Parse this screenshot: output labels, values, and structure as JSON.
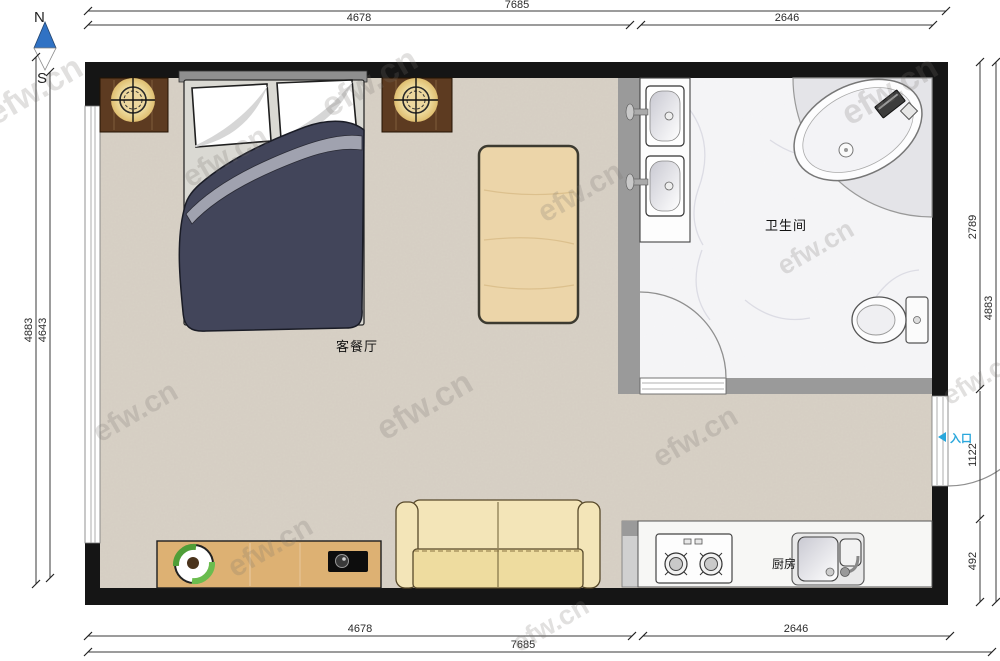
{
  "compass": {
    "north": "N",
    "south": "S"
  },
  "rooms": {
    "living_dining": "客餐厅",
    "bathroom": "卫生间",
    "kitchen": "厨房",
    "entrance": "入口"
  },
  "dimensions_mm": {
    "top_total": "7685",
    "top_left_segment": "4678",
    "top_right_segment": "2646",
    "bottom_left_segment": "4678",
    "bottom_right_segment": "2646",
    "bottom_total": "7685",
    "left_outer": "4883",
    "left_inner": "4643",
    "right_bathroom": "2789",
    "right_full": "4883",
    "right_entrance": "1122",
    "right_kitchen": "492"
  },
  "watermark": {
    "text": "efw.cn"
  },
  "colors": {
    "wall": "#151515",
    "partition_wall": "#9a9a9a",
    "floor": "#d8d1c6",
    "bathroom_floor": "#f5f5f7",
    "entrance_accent": "#2aa7dc",
    "compass_north": "#3072c4",
    "nightstand_wood": "#5d3b21",
    "cabinet_wood": "#ddb173",
    "sofa": "#f3e5b8",
    "duvet": "#42455a",
    "duvet_fold": "#a0a2af",
    "table_wood": "#ecd5a9",
    "lamp_glow": "#f0dfa4"
  }
}
